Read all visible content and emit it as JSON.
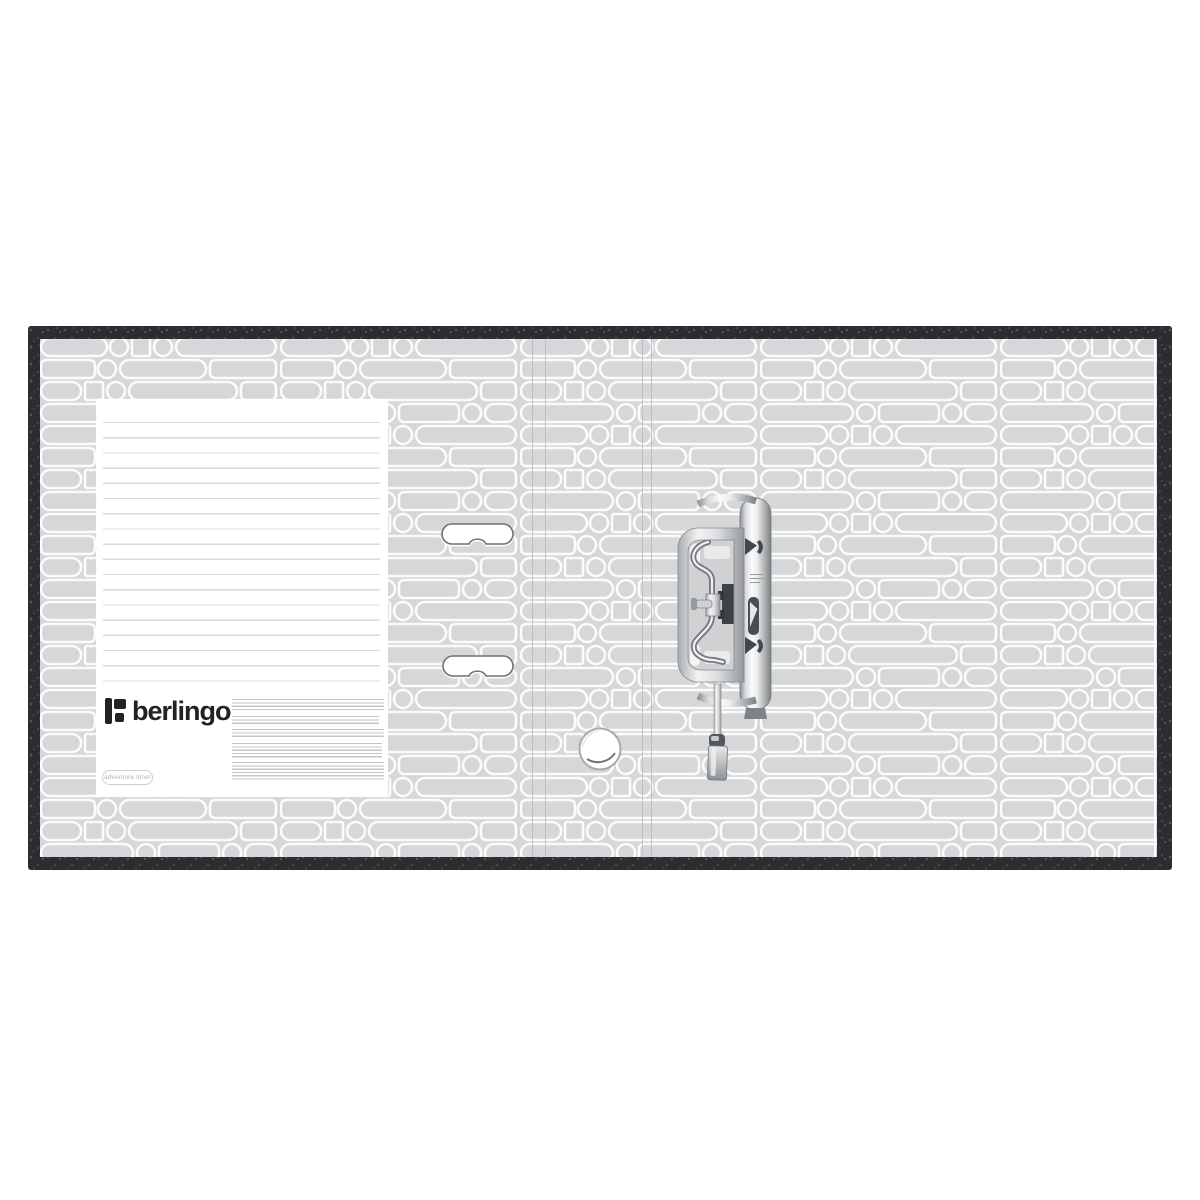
{
  "product": {
    "brand_wordmark": "berlingo",
    "badge_text": "adventure time!"
  },
  "scene": {
    "description_labels": {
      "binder": "open lever arch file binder, inside view",
      "label_panel": "blank ruled title label",
      "mechanism": "chrome lever arch mechanism, side view"
    }
  },
  "label_panel": {
    "ruled_line_count": 19,
    "fine_print_paragraphs": 5
  },
  "palette": {
    "cover_dark": "#2b2d30",
    "liner_gray": "#d5d7d9",
    "pattern_stroke": "#fafbfb",
    "panel_white": "#ffffff",
    "rule_line_gray": "#dadadc",
    "logo_black": "#222226",
    "chrome_light": "#fafbfc",
    "chrome_dark": "#7e8184",
    "fine_print_gray": "#c3c5c8"
  }
}
